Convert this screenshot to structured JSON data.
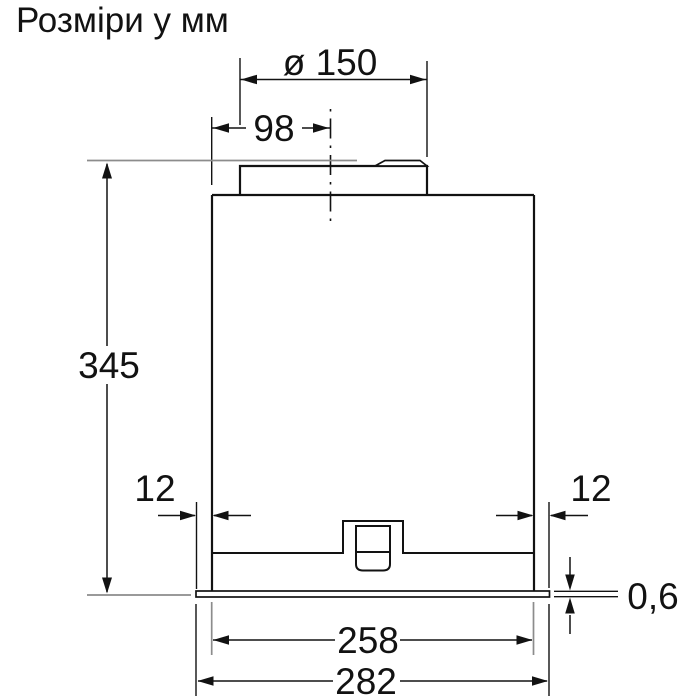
{
  "title": "Розміри у мм",
  "colors": {
    "line": "#121212",
    "extension_gray": "#8c8c8c",
    "background": "#ffffff"
  },
  "diagram": {
    "kind": "technical-dimension-drawing",
    "units": "mm",
    "dimensions": {
      "duct_diameter": "ø 150",
      "duct_center_offset": "98",
      "body_height": "345",
      "inset_left": "12",
      "inset_right": "12",
      "flange_thickness": "0,6",
      "inner_width": "258",
      "outer_width": "282"
    }
  }
}
